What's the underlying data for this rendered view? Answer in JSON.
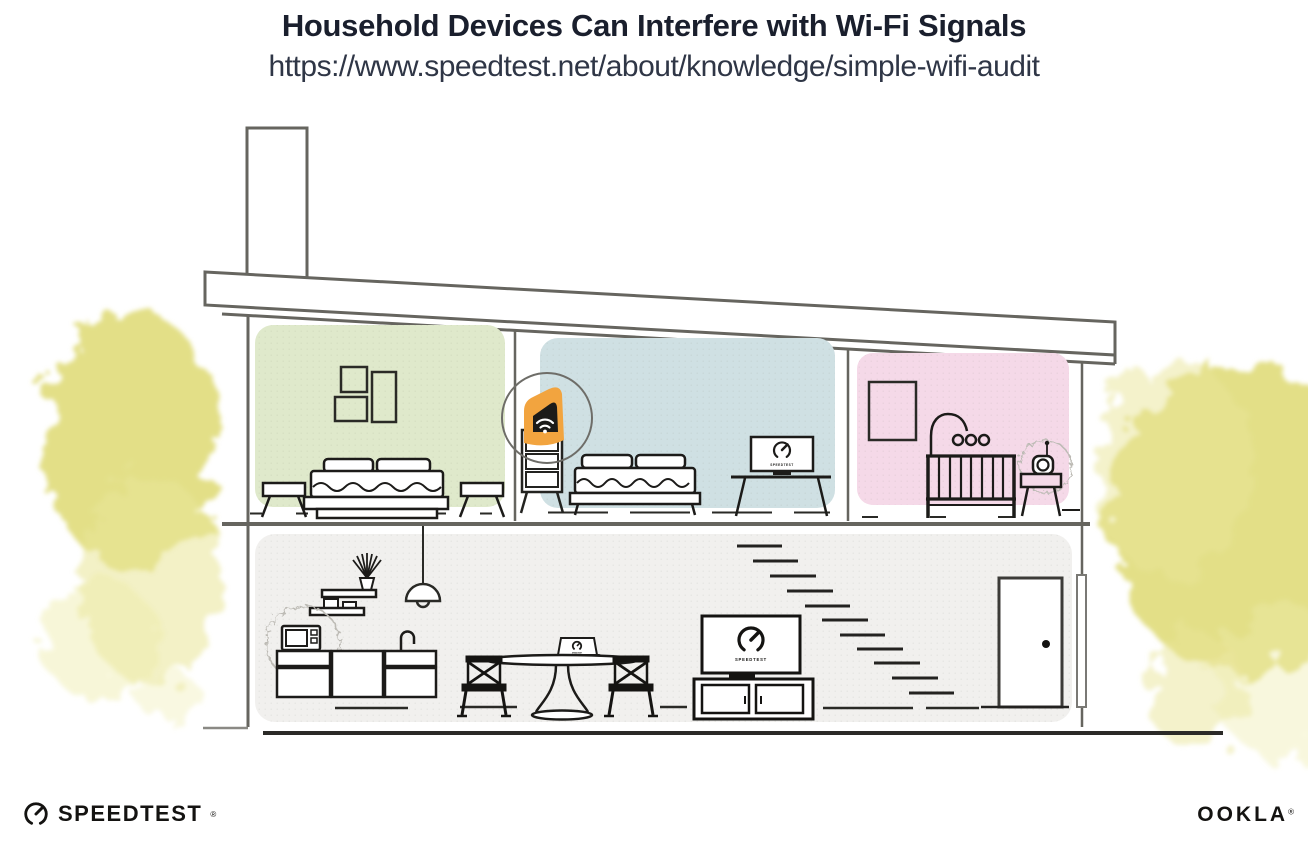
{
  "header": {
    "title": "Household Devices Can Interfere with Wi-Fi Signals",
    "url": "https://www.speedtest.net/about/knowledge/simple-wifi-audit"
  },
  "screens": {
    "tv_label": "SPEEDTEST",
    "bedroom_laptop_label": "SPEEDTEST",
    "dining_laptop_label": "SPEEDTEST"
  },
  "footer": {
    "speedtest_wordmark": "SPEEDTEST",
    "speedtest_trademark": "®",
    "ookla_wordmark": "OOKLA",
    "ookla_trademark": "®"
  },
  "icons": {
    "wifi_icon": "wifi arcs on router",
    "speedtest_gauge_icon": "open circle gauge with needle",
    "interference_burst_icon": "wavy static cloud around microwave and baby monitor"
  },
  "colors": {
    "accent_orange": "#F2A43F",
    "room_green": "#DFE9CB",
    "room_blue": "#CFE0E3",
    "room_pink": "#F5D9E8",
    "lower_floor_gray": "#F1F0EE",
    "foliage_yellow": "#DFDB76",
    "structure_gray": "#66655F",
    "ink_black": "#1C1B19",
    "title_navy": "#1A1F2D"
  }
}
